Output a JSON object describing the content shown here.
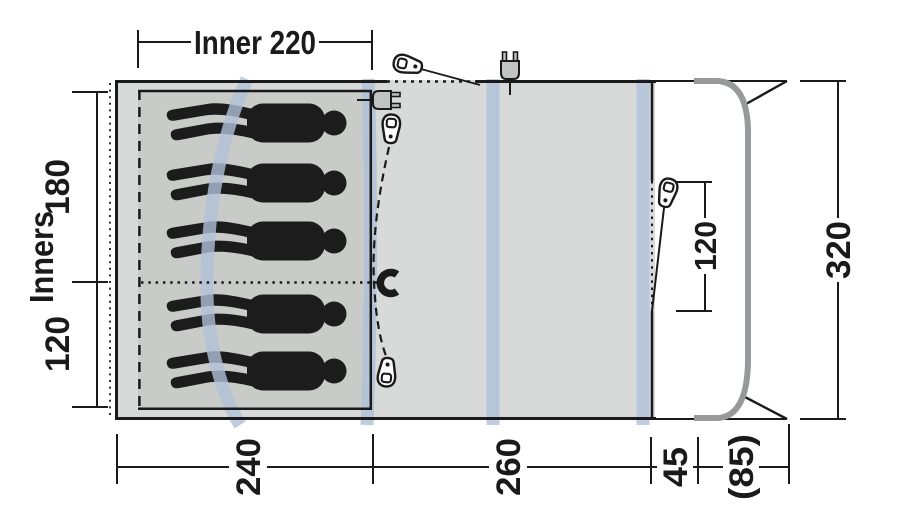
{
  "diagram": {
    "type": "tent-floorplan-top-view",
    "sleepers": 5,
    "labels": {
      "inner_width": "Inner 220",
      "inners_axis": "Inners",
      "inner_depth_back": "180",
      "inner_depth_front": "120",
      "total_depth": "320",
      "front_door_width": "120",
      "width_bedroom": "240",
      "width_living": "260",
      "width_front": "45",
      "width_canopy": "(85)"
    },
    "colors": {
      "floor": "#d8dad9",
      "inner_floor": "#c9cbc9",
      "pole": "#b0c0d8",
      "canopy_pole": "#98999b",
      "line": "#1a1a1a",
      "silhouette": "#1c1c1c"
    },
    "icons": [
      "toggle-tieback-top",
      "power-plug-top",
      "power-plug-inner",
      "toggle-living-door-top",
      "magnet-door-closure",
      "toggle-living-door-bottom",
      "toggle-front-door"
    ]
  }
}
